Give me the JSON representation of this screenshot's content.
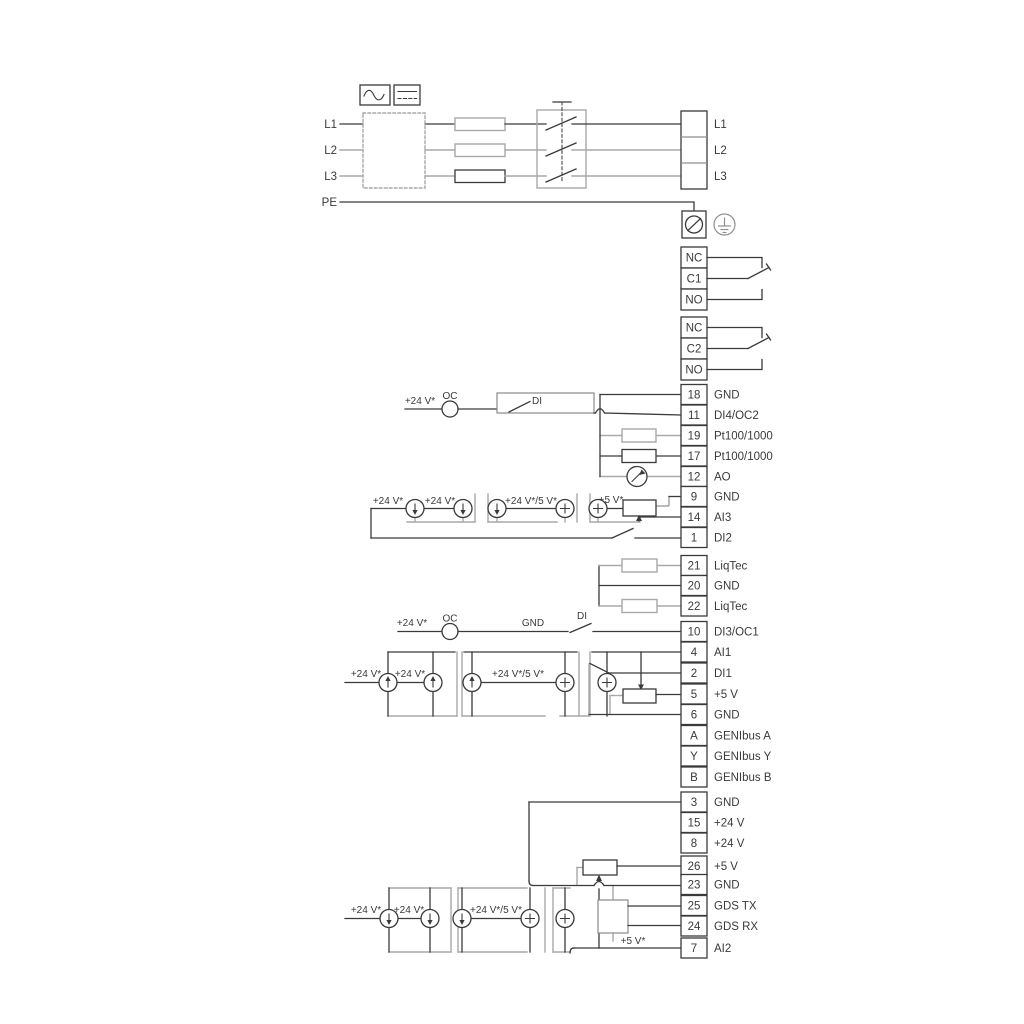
{
  "colors": {
    "wire_black": "#3a3a3a",
    "wire_gray": "#a9a9a9",
    "background": "#ffffff"
  },
  "power_in": {
    "l1": "L1",
    "l2": "L2",
    "l3": "L3",
    "pe": "PE"
  },
  "mains_out": {
    "l1": "L1",
    "l2": "L2",
    "l3": "L3"
  },
  "relays": [
    {
      "top": "NC",
      "mid": "C1",
      "bot": "NO"
    },
    {
      "top": "NC",
      "mid": "C2",
      "bot": "NO"
    }
  ],
  "ann": {
    "v24": "+24 V*",
    "v24_5": "+24 V*/5 V*",
    "v5": "+5 V*",
    "oc": "OC",
    "di": "DI",
    "gnd": "GND"
  },
  "terminals": [
    {
      "num": "18",
      "label": "GND"
    },
    {
      "num": "11",
      "label": "DI4/OC2"
    },
    {
      "num": "19",
      "label": "Pt100/1000"
    },
    {
      "num": "17",
      "label": "Pt100/1000"
    },
    {
      "num": "12",
      "label": "AO"
    },
    {
      "num": "9",
      "label": "GND"
    },
    {
      "num": "14",
      "label": "AI3"
    },
    {
      "num": "1",
      "label": "DI2"
    },
    {
      "num": "21",
      "label": "LiqTec"
    },
    {
      "num": "20",
      "label": "GND"
    },
    {
      "num": "22",
      "label": "LiqTec"
    },
    {
      "num": "10",
      "label": "DI3/OC1"
    },
    {
      "num": "4",
      "label": "AI1"
    },
    {
      "num": "2",
      "label": "DI1"
    },
    {
      "num": "5",
      "label": "+5 V"
    },
    {
      "num": "6",
      "label": "GND"
    },
    {
      "num": "A",
      "label": "GENIbus A"
    },
    {
      "num": "Y",
      "label": "GENIbus Y"
    },
    {
      "num": "B",
      "label": "GENIbus B"
    },
    {
      "num": "3",
      "label": "GND"
    },
    {
      "num": "15",
      "label": "+24 V"
    },
    {
      "num": "8",
      "label": "+24 V"
    },
    {
      "num": "26",
      "label": "+5 V"
    },
    {
      "num": "23",
      "label": "GND"
    },
    {
      "num": "25",
      "label": "GDS TX"
    },
    {
      "num": "24",
      "label": "GDS RX"
    },
    {
      "num": "7",
      "label": "AI2"
    }
  ]
}
